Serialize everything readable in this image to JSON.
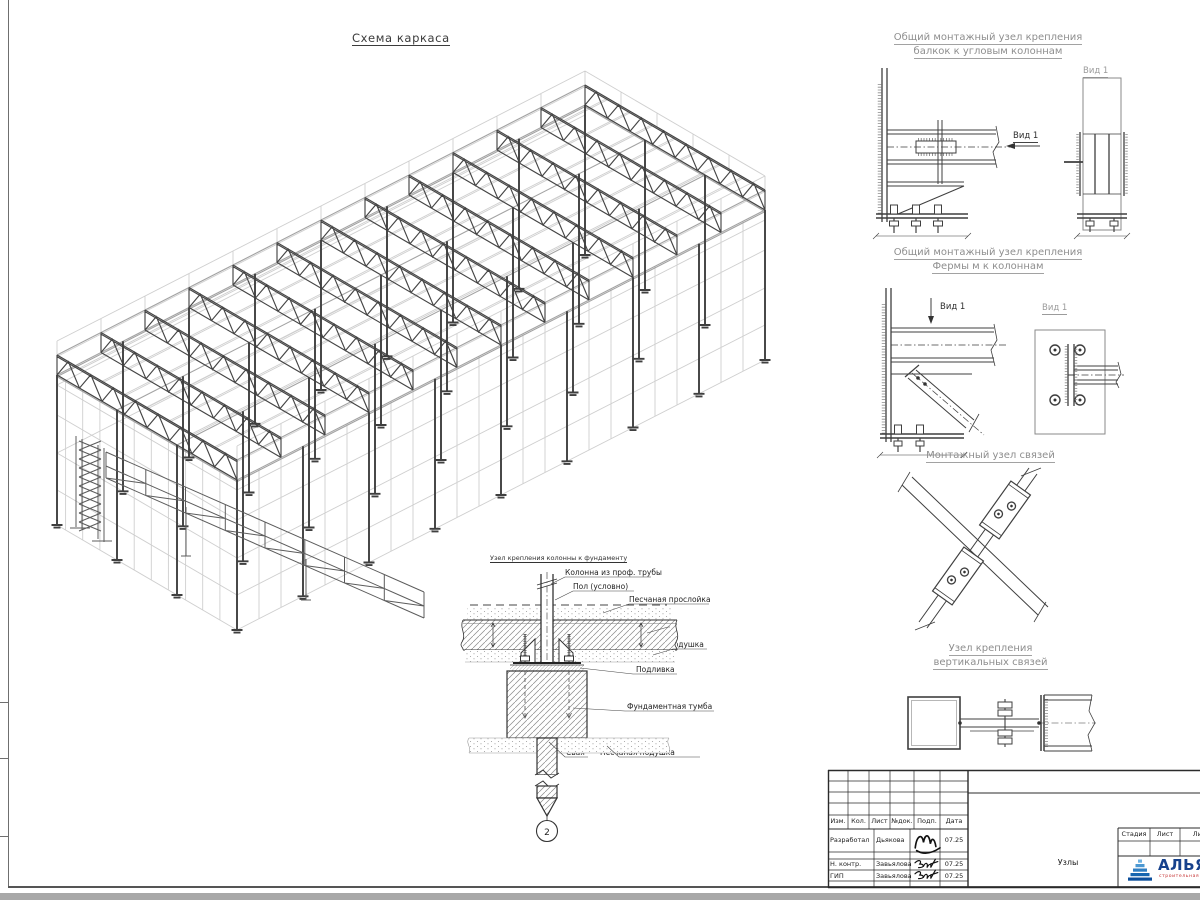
{
  "main_title": "Схема каркаса",
  "details": {
    "beam_corner": {
      "title1": "Общий монтажный узел крепления",
      "title2": "балкок к угловым колоннам",
      "view_arrow": "Вид 1",
      "view_title": "Вид 1"
    },
    "truss_column": {
      "title1": "Общий монтажный узел крепления",
      "title2": "Фермы м к колоннам",
      "view_arrow": "Вид 1",
      "view_title": "Вид 1"
    },
    "braces": {
      "title": "Монтажный узел связей"
    },
    "vertical_braces": {
      "title1": "Узел крепления",
      "title2": "вертикальных связей"
    }
  },
  "foundation": {
    "title": "Узел крепления колонны к фундаменту",
    "labels": [
      "Колонна из проф. трубы",
      "Пол (условно)",
      "Песчаная прослойка",
      "Ростверк",
      "Песчаная подушка",
      "Подливка",
      "Фундаментная тумба",
      "Свая",
      "Песчаная подушка"
    ],
    "marker": "2"
  },
  "title_block": {
    "rev_headers": [
      "Изм.",
      "Кол.",
      "Лист",
      "№док.",
      "Подп.",
      "Дата"
    ],
    "sign_rows": [
      {
        "role": "Разработал",
        "name": "Дьякова",
        "date": "07.25"
      },
      {
        "role": "Н. контр.",
        "name": "Завьялова",
        "date": "07.25"
      },
      {
        "role": "ГИП",
        "name": "Завьялова",
        "date": "07.25"
      }
    ],
    "stage_headers": [
      "Стадия",
      "Лист",
      "Лист"
    ],
    "doc_name": "Узлы",
    "logo": {
      "name": "АЛЬЯНС",
      "tagline": "строительная компания",
      "accent": "#16418c",
      "tag_color": "#c53030"
    }
  },
  "frame_scheme": {
    "bays_length": 8,
    "bays_width": 3,
    "trusses": 13,
    "purlins": 9,
    "dark_color": "#454545",
    "mid_color": "#a3a3a3",
    "light_color": "#cfcfcf"
  }
}
